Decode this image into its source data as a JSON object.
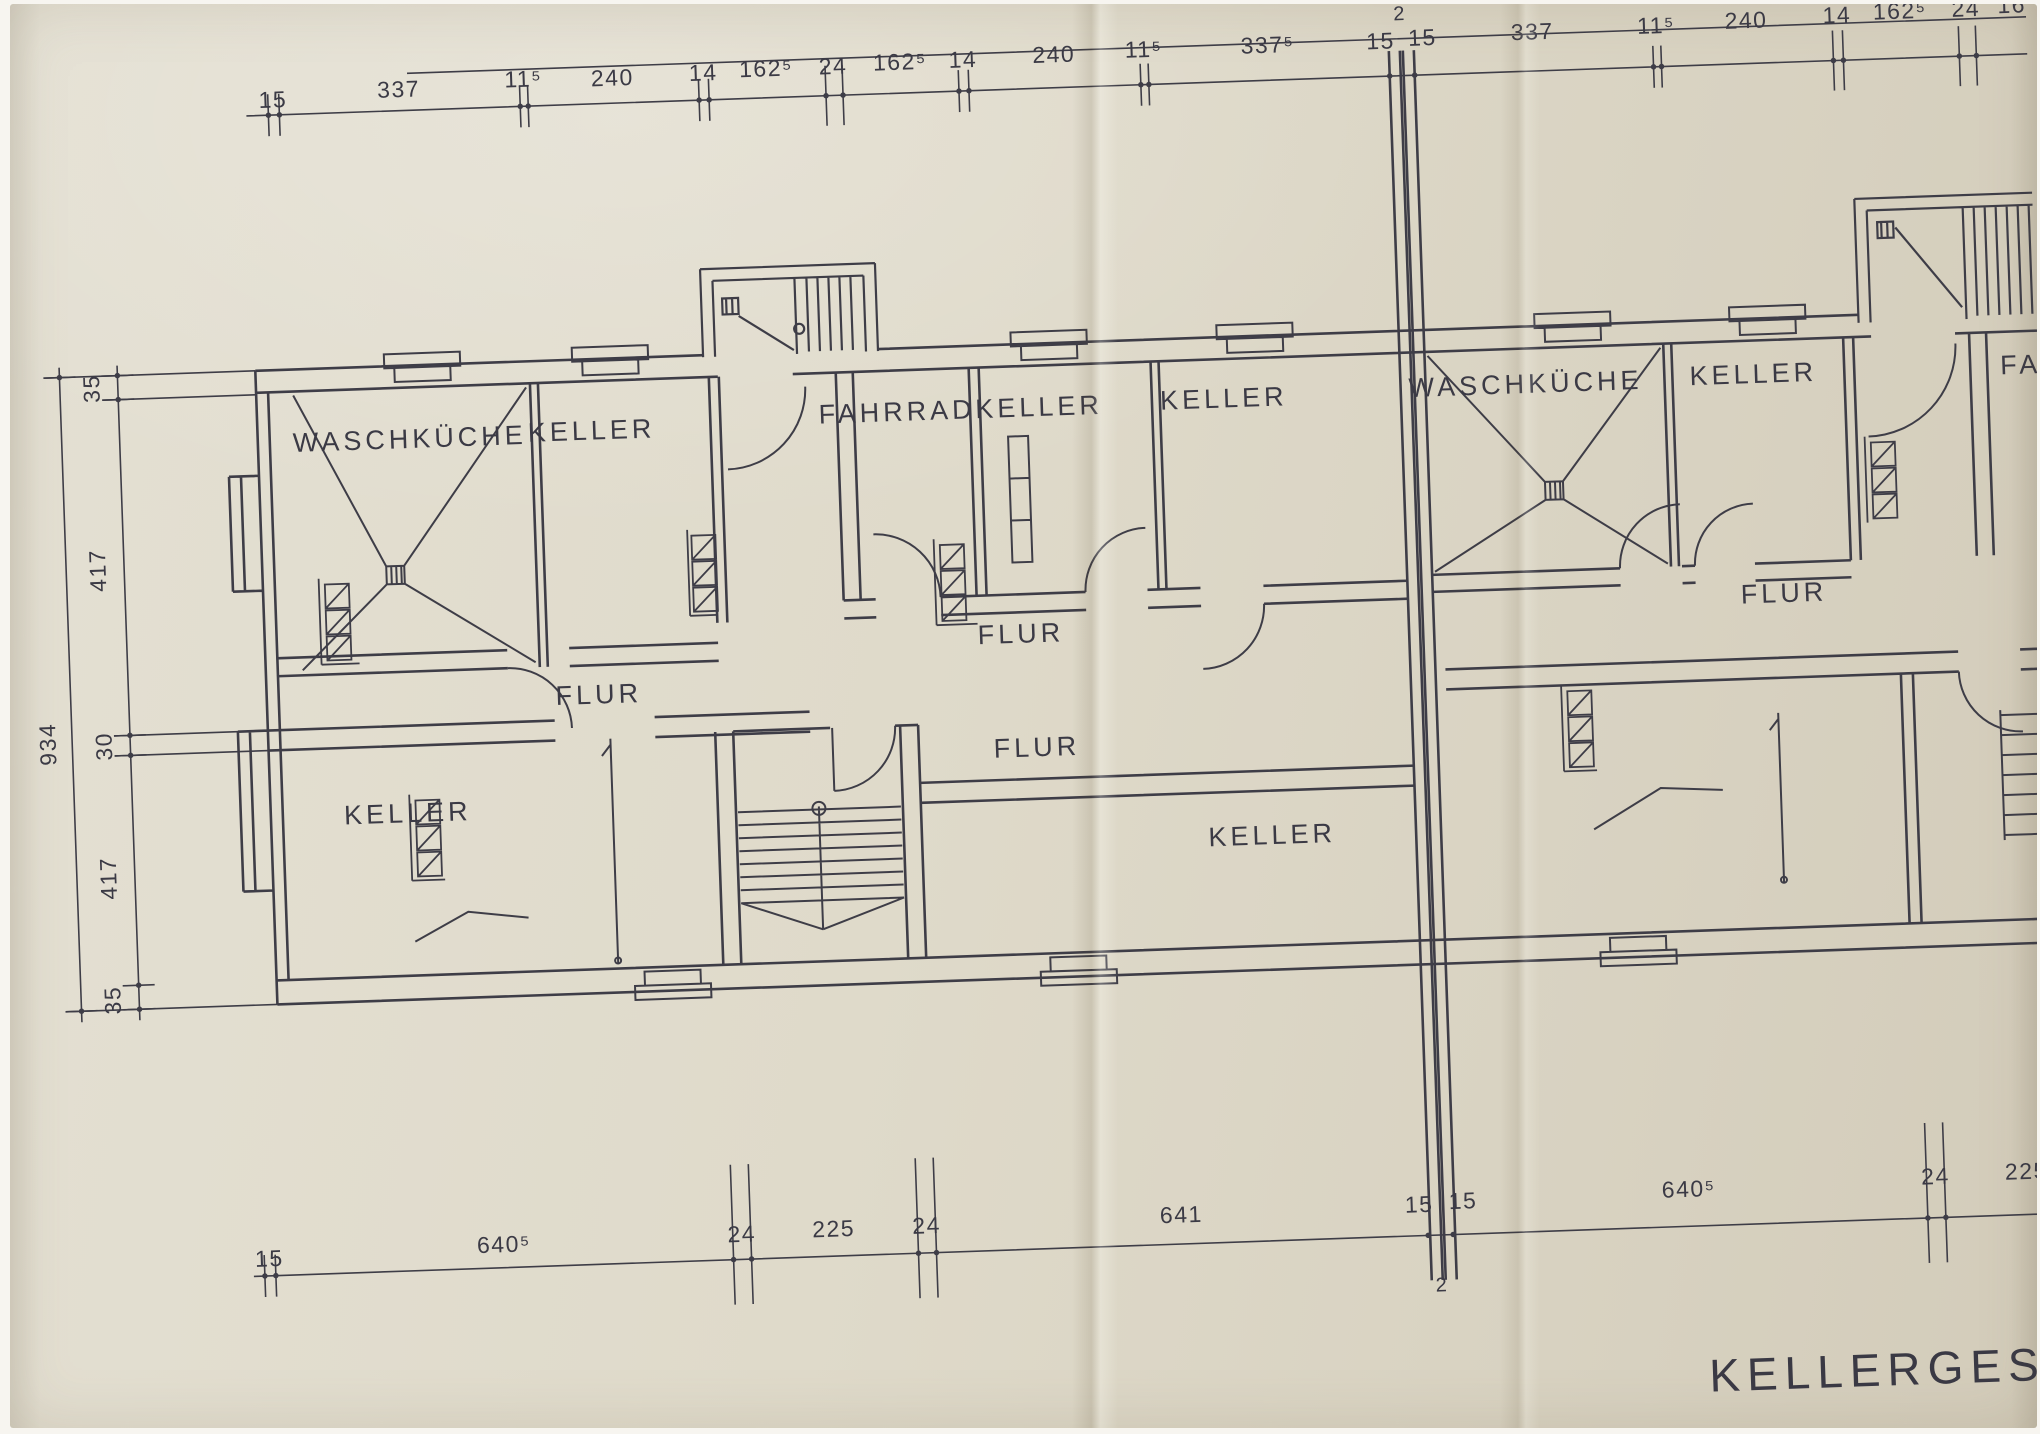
{
  "drawing": {
    "title": "KELLERGESCHO"
  },
  "room_labels": {
    "waschkueche_1": "WASCHKÜCHE",
    "keller_top_left": "KELLER",
    "fahrrad": "FAHRRAD",
    "keller_top_mid": "KELLER",
    "keller_top_right": "KELLER",
    "waschkueche_2": "WASCHKÜCHE",
    "keller_top_unit2": "KELLER",
    "fahrrad_unit2": "FA",
    "flur_left": "FLUR",
    "flur_mid_upper": "FLUR",
    "flur_mid_lower": "FLUR",
    "flur_unit2": "FLUR",
    "keller_bottom_left": "KELLER",
    "keller_bottom_right": "KELLER"
  },
  "dimensions": {
    "top": [
      "15",
      "337",
      "11⁵",
      "240",
      "14",
      "162⁵",
      "24",
      "162⁵",
      "14",
      "240",
      "11⁵",
      "337⁵",
      "15",
      "2",
      "15",
      "337",
      "11⁵",
      "240",
      "14",
      "162⁵",
      "24",
      "16"
    ],
    "bottom": [
      "15",
      "640⁵",
      "24",
      "225",
      "24",
      "641",
      "15",
      "2",
      "15",
      "640⁵",
      "24",
      "225"
    ],
    "left": [
      "35",
      "417",
      "30",
      "417",
      "35"
    ],
    "left_total": "934"
  }
}
